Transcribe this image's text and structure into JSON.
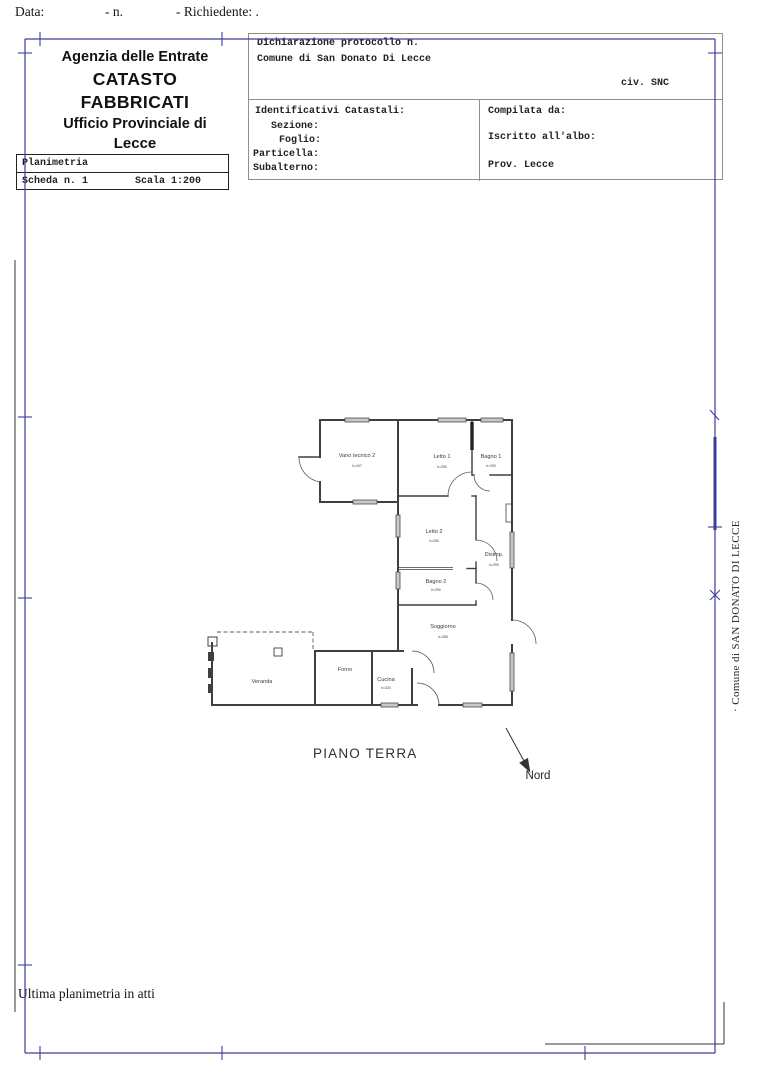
{
  "header": {
    "top_line": {
      "data": "Data:",
      "n": "- n.",
      "richiedente": "- Richiedente: ."
    },
    "agency": {
      "line1": "Agenzia delle Entrate",
      "line2": "CATASTO FABBRICATI",
      "line3": "Ufficio Provinciale di",
      "line4": "Lecce"
    },
    "planimetria": {
      "title": "Planimetria",
      "scheda": "Scheda n. 1",
      "scala": "Scala 1:200"
    },
    "declaration": {
      "protocollo": "Dichiarazione protocollo n.",
      "comune": "Comune di San Donato Di Lecce",
      "civ": "civ. SNC",
      "identificativi": "Identificativi Catastali:",
      "sezione": "Sezione:",
      "foglio": "Foglio:",
      "particella": "Particella:",
      "subalterno": "Subalterno:",
      "compilata": "Compilata da:",
      "iscritto": "Iscritto all'albo:",
      "prov": "Prov. Lecce"
    }
  },
  "plan": {
    "floor_label": "PIANO TERRA",
    "north_label": "Nord",
    "rooms": [
      {
        "name": "Vano tecnico 2",
        "height": "h=247"
      },
      {
        "name": "Letto 1",
        "height": "h=290"
      },
      {
        "name": "Bagno 1",
        "height": "h=290"
      },
      {
        "name": "Letto 2",
        "height": "h=290"
      },
      {
        "name": "Disimp.",
        "height": "h=290"
      },
      {
        "name": "Bagno 2",
        "height": "h=290"
      },
      {
        "name": "Soggiorno",
        "height": "h=285"
      },
      {
        "name": "Veranda",
        "height": ""
      },
      {
        "name": "Forno",
        "height": ""
      },
      {
        "name": "Cucina",
        "height": "h=320"
      }
    ]
  },
  "margins": {
    "side_text": "· Comune di SAN DONATO DI LECCE",
    "footer_note": "Ultima planimetria in atti"
  },
  "colors": {
    "frame": "#3d3d99",
    "wall": "#3f3f3f",
    "scan_mark": "#35353f"
  }
}
